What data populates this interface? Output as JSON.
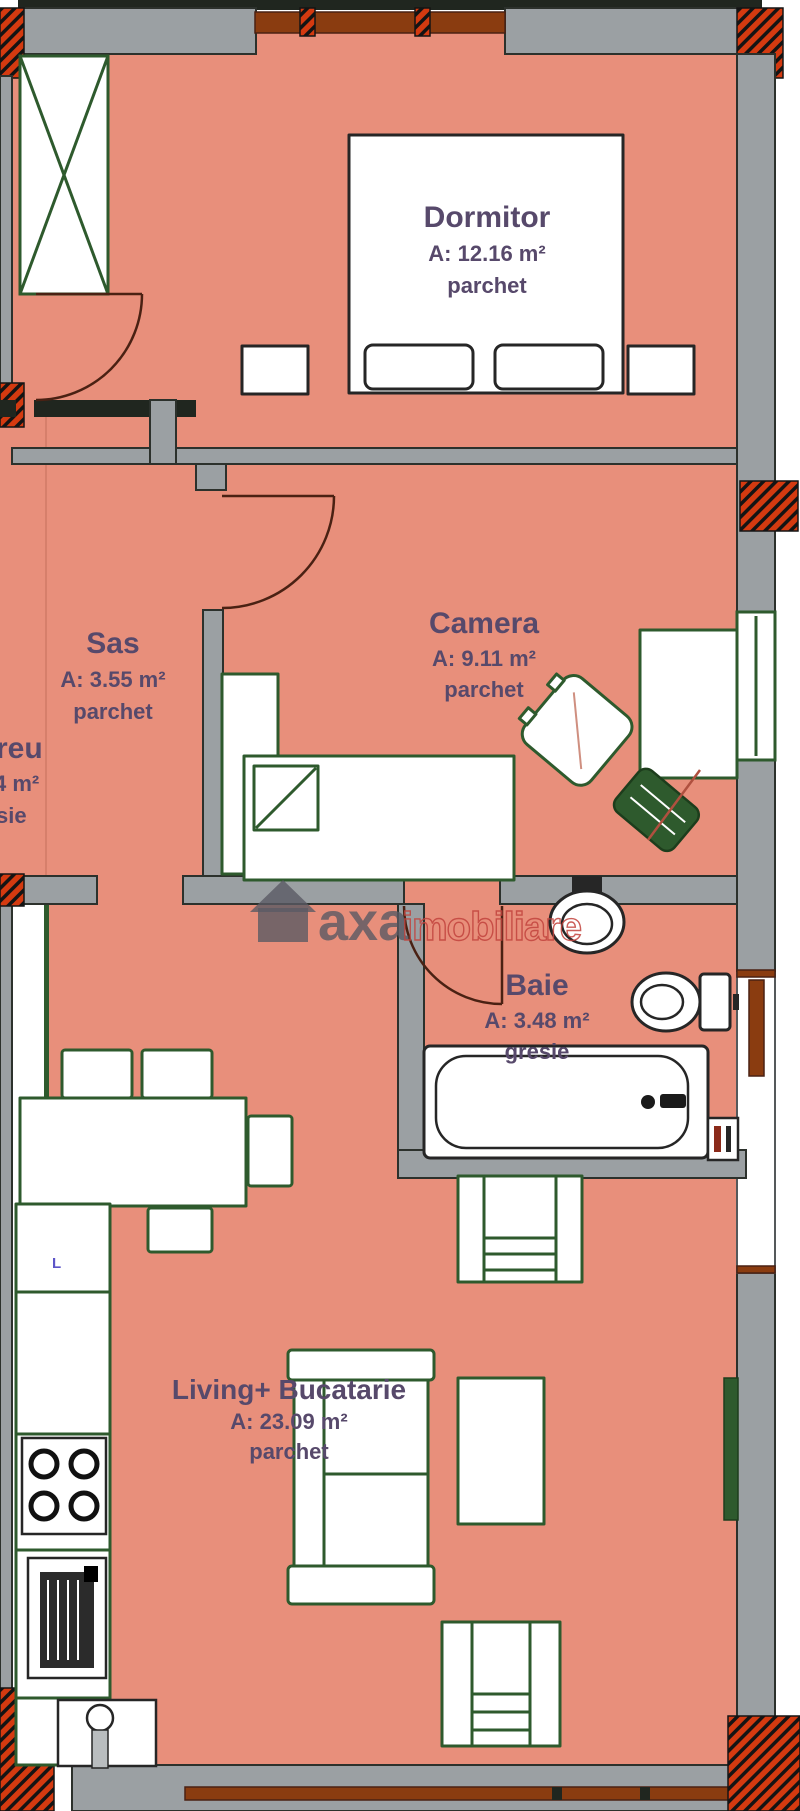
{
  "plan": {
    "rooms": [
      {
        "name": "Dormitor",
        "area": "A: 12.16 m²",
        "floor": "parchet"
      },
      {
        "name": "Sas",
        "area": "A: 3.55 m²",
        "floor": "parchet"
      },
      {
        "name": "Camera",
        "area": "A: 9.11 m²",
        "floor": "parchet"
      },
      {
        "name": "Baie",
        "area": "A: 3.48 m²",
        "floor": "gresie"
      },
      {
        "name": "Living+ Bucatarie",
        "area": "A: 23.09 m²",
        "floor": "parchet"
      }
    ],
    "partial": {
      "l1": "reu",
      "l2": "4 m²",
      "l3": "sie"
    },
    "watermark": {
      "brand": "axa",
      "word": "imobiliare"
    },
    "kitchen_marker": "L",
    "colors": {
      "floor_salmon": "#e88f7b",
      "wall_gray": "#9ba0a3",
      "furniture_green": "#2e5a2d",
      "hatch_red": "#d43a10",
      "wood_brown": "#8a3c10",
      "door_arc": "#4a2113",
      "label_purple": "#57496b",
      "watermark_gray": "#5a5a64",
      "watermark_red": "#c2433d"
    }
  }
}
